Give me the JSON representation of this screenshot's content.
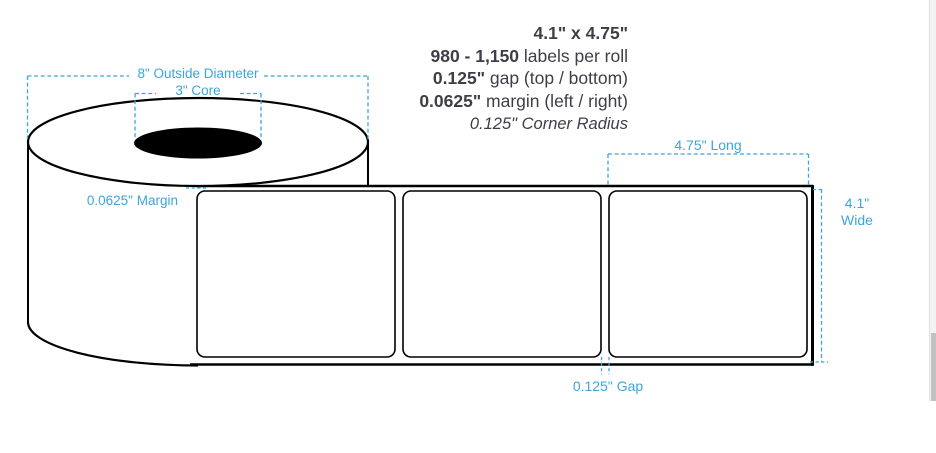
{
  "specs": {
    "size": "4.1\" x 4.75\"",
    "count_strong": "980 - 1,150",
    "count_rest": " labels per roll",
    "gap_strong": "0.125\"",
    "gap_rest": " gap (top / bottom)",
    "margin_strong": "0.0625\"",
    "margin_rest": " margin (left / right)",
    "corner_radius": "0.125\" Corner Radius"
  },
  "annotations": {
    "outside_diameter": "8\" Outside Diameter",
    "core": "3\" Core",
    "margin": "0.0625\" Margin",
    "length": "4.75\" Long",
    "width_line1": "4.1\"",
    "width_line2": "Wide",
    "gap": "0.125\" Gap"
  },
  "colors": {
    "annotation_blue": "#3CA5DD",
    "spec_text": "#3E3E46",
    "diagram_stroke": "#000000",
    "scrollbar_track": "#f3f3f3",
    "scrollbar_thumb": "#c1c1c1"
  }
}
